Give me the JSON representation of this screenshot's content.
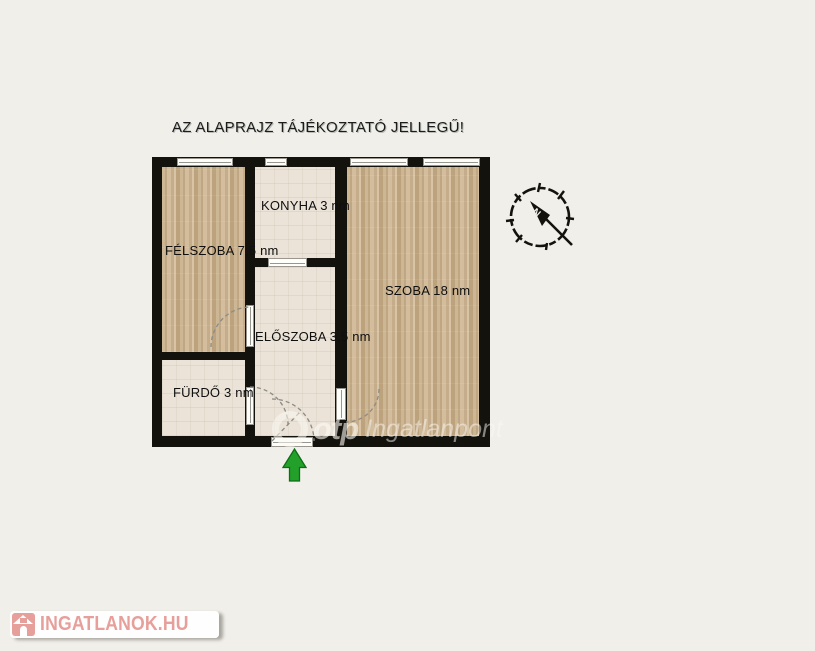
{
  "title": {
    "text": "AZ ALAPRAJZ TÁJÉKOZTATÓ JELLEGŰ!"
  },
  "rooms": {
    "felszoba": {
      "label": "FÉLSZOBA 7,5 nm",
      "area_nm": "7,5",
      "floor": "wood"
    },
    "konyha": {
      "label": "KONYHA 3 nm",
      "area_nm": "3",
      "floor": "tile"
    },
    "szoba": {
      "label": "SZOBA 18 nm",
      "area_nm": "18",
      "floor": "wood"
    },
    "eloszoba": {
      "label": "ELŐSZOBA 3,5 nm",
      "area_nm": "3,5",
      "floor": "tile"
    },
    "furdo": {
      "label": "FÜRDŐ 3 nm",
      "area_nm": "3",
      "floor": "tile"
    }
  },
  "compass": {
    "letter": "N"
  },
  "watermark": {
    "brand": "otp",
    "product": "Ingatlanpont"
  },
  "logo": {
    "text": "INGATLANOK.HU"
  },
  "colors": {
    "background": "#f0efe9",
    "wall": "#14120c",
    "wood_floor": "#c9b191",
    "tile_floor": "#ebe3d8",
    "entrance_arrow_green": "#22a02a",
    "logo_pink": "#e79f9b"
  }
}
